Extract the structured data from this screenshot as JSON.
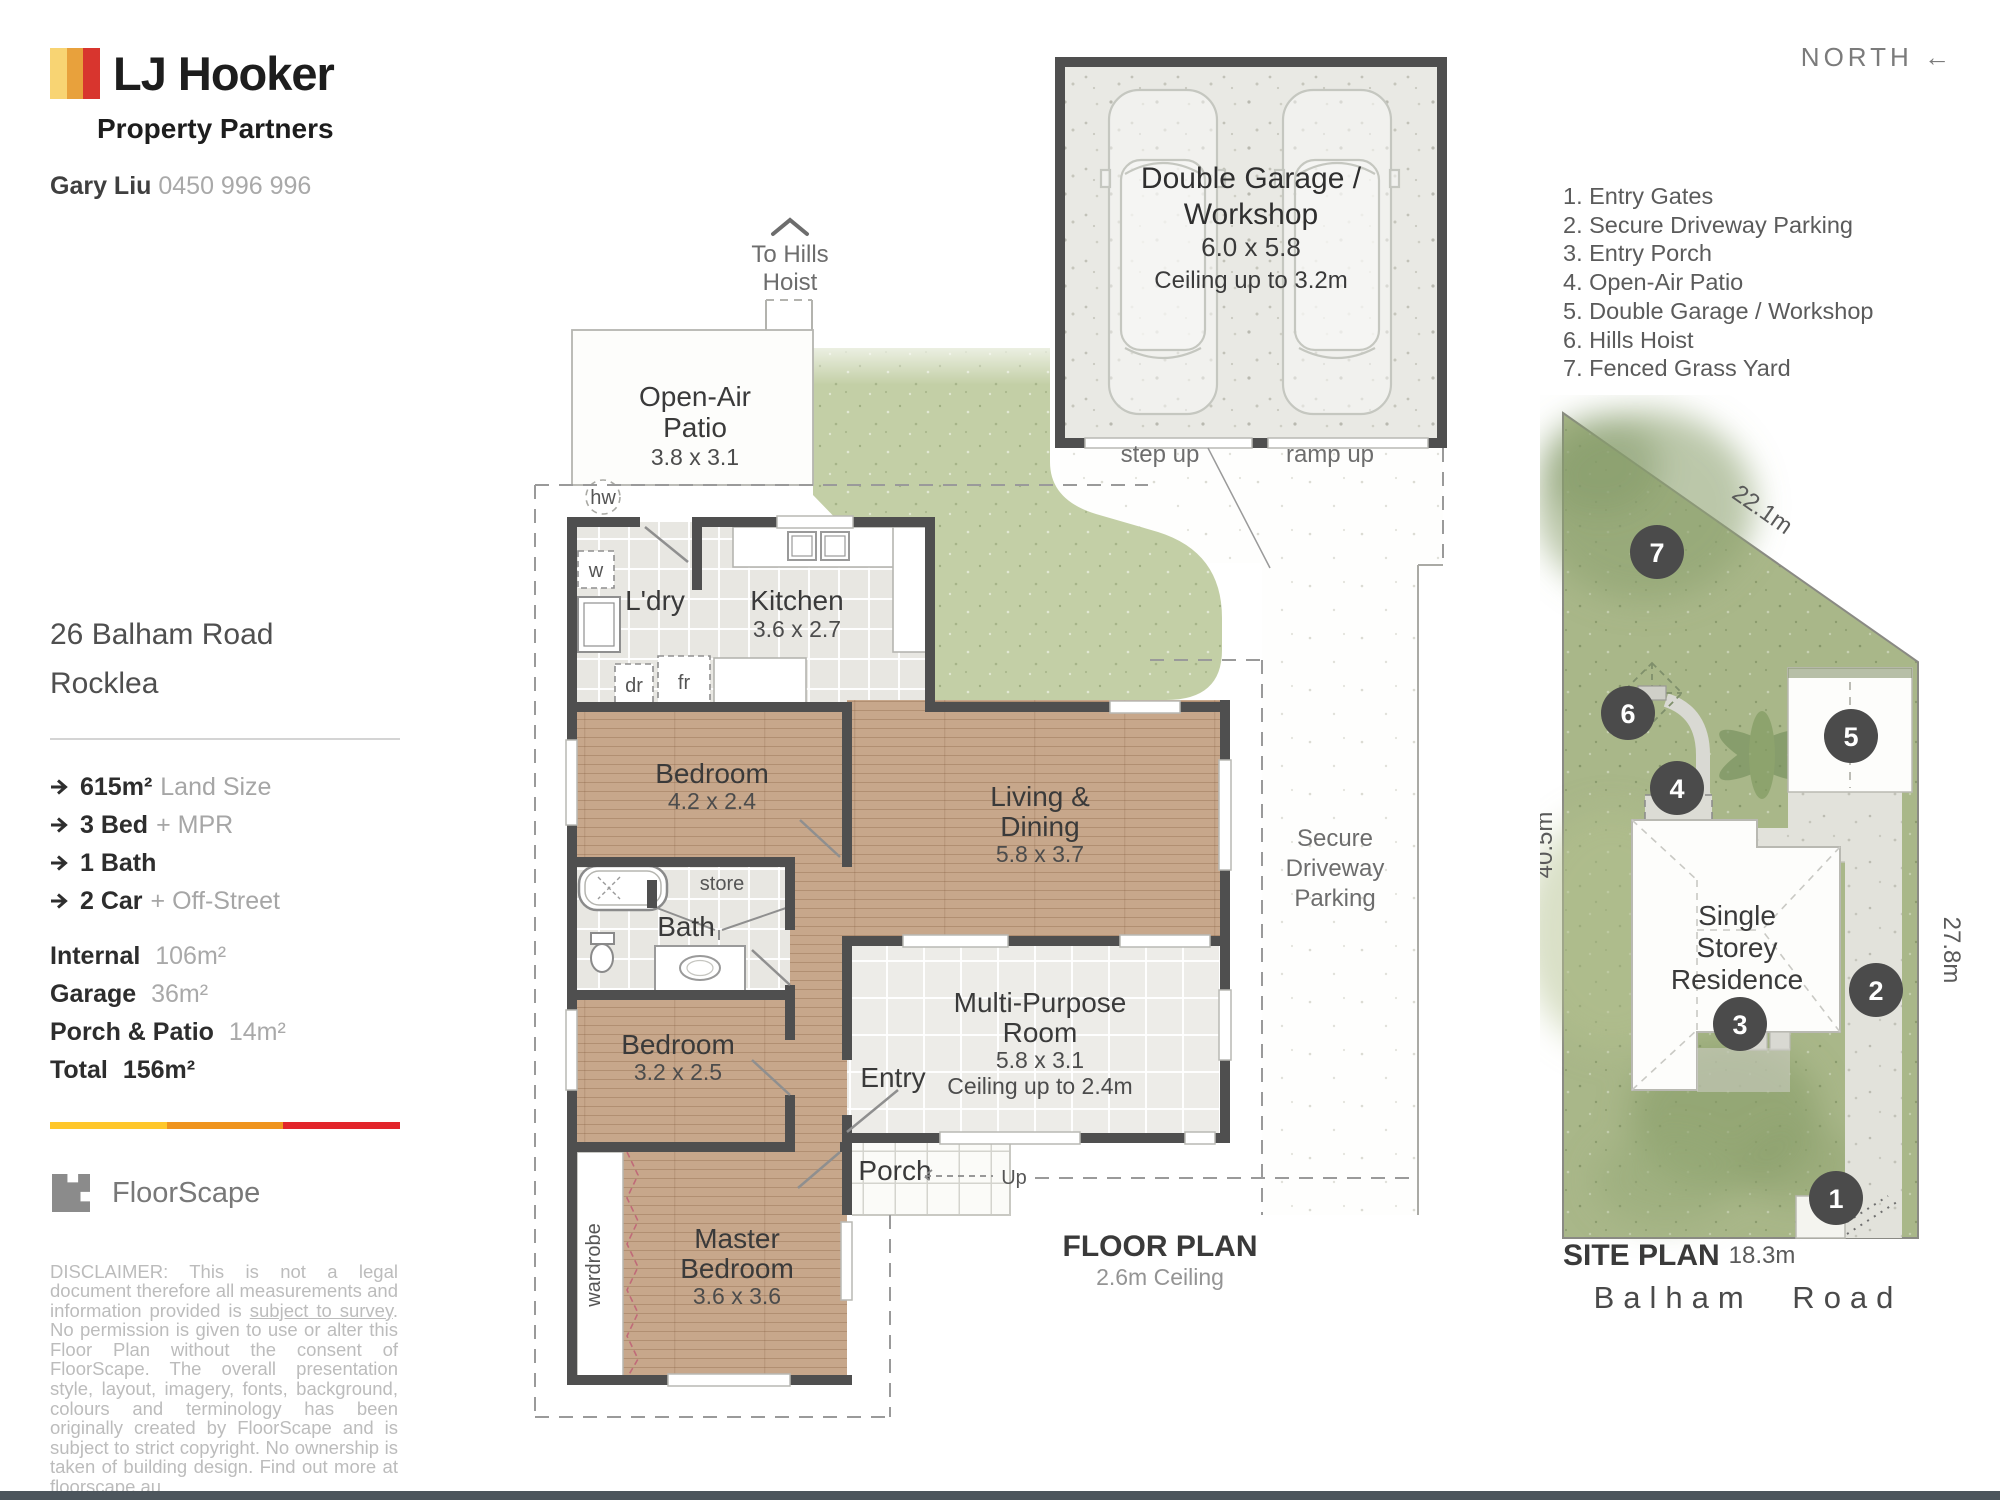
{
  "header": {
    "brand": "LJ Hooker",
    "brand_sub": "Property Partners",
    "agent": "Gary Liu",
    "phone": "0450 996 996",
    "north": "NORTH",
    "north_arrow": "←"
  },
  "sidebar": {
    "address1": "26 Balham Road",
    "address2": "Rocklea",
    "stats": [
      {
        "b": "615m²",
        "r": "Land Size"
      },
      {
        "b": "3 Bed",
        "r": "+ MPR"
      },
      {
        "b": "1 Bath",
        "r": ""
      },
      {
        "b": "2 Car",
        "r": "+ Off-Street"
      }
    ],
    "areas": [
      {
        "b": "Internal",
        "r": "106m²"
      },
      {
        "b": "Garage",
        "r": "36m²"
      },
      {
        "b": "Porch & Patio",
        "r": "14m²"
      },
      {
        "b": "Total",
        "r": "156m²"
      }
    ]
  },
  "floorscape": {
    "name": "FloorScape",
    "disclaimer_pre": "DISCLAIMER: This is not a legal document therefore all measurements and information provided is ",
    "disclaimer_underline": "subject to survey",
    "disclaimer_post": ". No permission is given to use or alter this Floor Plan without the consent of FloorScape. The overall presentation style, layout, imagery, fonts, background, colours and terminology has been originally created by FloorScape and is subject to strict copyright. No ownership is taken of building design. Find out more at floorscape.au"
  },
  "plan": {
    "title": "FLOOR PLAN",
    "subtitle": "2.6m Ceiling",
    "to_hills": {
      "l1": "To Hills",
      "l2": "Hoist"
    },
    "patio": {
      "l1": "Open-Air",
      "l2": "Patio",
      "dims": "3.8 x 3.1"
    },
    "hw": "hw",
    "ldry": {
      "name": "L'dry",
      "w": "w",
      "dr": "dr",
      "fr": "fr"
    },
    "kitchen": {
      "name": "Kitchen",
      "dims": "3.6 x 2.7"
    },
    "bedroom1": {
      "name": "Bedroom",
      "dims": "4.2 x 2.4"
    },
    "living": {
      "l1": "Living &",
      "l2": "Dining",
      "dims": "5.8 x 3.7"
    },
    "bath": {
      "name": "Bath",
      "store": "store"
    },
    "bedroom2": {
      "name": "Bedroom",
      "dims": "3.2 x 2.5"
    },
    "mpr": {
      "l1": "Multi-Purpose",
      "l2": "Room",
      "dims": "5.8 x 3.1",
      "ceiling": "Ceiling up to 2.4m"
    },
    "entry": "Entry",
    "porch": "Porch",
    "up": "Up",
    "master": {
      "l1": "Master",
      "l2": "Bedroom",
      "dims": "3.6 x 3.6",
      "wardrobe": "wardrobe"
    },
    "garage": {
      "l1": "Double Garage /",
      "l2": "Workshop",
      "dims": "6.0 x 5.8",
      "ceiling": "Ceiling up to 3.2m",
      "step": "step up",
      "ramp": "ramp up"
    },
    "driveway": {
      "l1": "Secure",
      "l2": "Driveway",
      "l3": "Parking"
    }
  },
  "legend": {
    "items": [
      "1. Entry Gates",
      "2. Secure Driveway Parking",
      "3. Entry Porch",
      "4. Open-Air Patio",
      "5. Double Garage / Workshop",
      "6. Hills Hoist",
      "7. Fenced Grass Yard"
    ]
  },
  "site": {
    "title": "SITE PLAN",
    "street": "Balham Road",
    "residence": {
      "l1": "Single",
      "l2": "Storey",
      "l3": "Residence"
    },
    "dims": {
      "top": "22.1m",
      "left": "40.5m",
      "right": "27.8m",
      "bottom": "18.3m"
    },
    "markers": {
      "m1": "1",
      "m2": "2",
      "m3": "3",
      "m4": "4",
      "m5": "5",
      "m6": "6",
      "m7": "7"
    }
  },
  "colors": {
    "brand_yellow": "#F8D473",
    "brand_orange": "#E8A13C",
    "brand_red": "#D8352E",
    "bar_yellow": "#FFC72B",
    "bar_orange": "#EF941E",
    "bar_red": "#E2252B",
    "wall": "#4f4f4f",
    "wood": "#c7a78b",
    "tile": "#e8e7e2",
    "plan_grass": "#c3cfa6",
    "site_grass": "#a9b789",
    "marker": "#4b4b4b",
    "footer": "#4C555C"
  }
}
